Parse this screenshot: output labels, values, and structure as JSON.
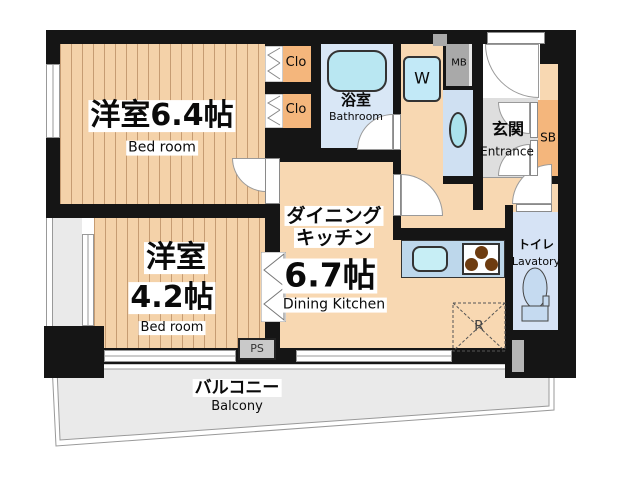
{
  "plan": {
    "title": "Japanese apartment floor plan (1DK with balcony)",
    "rooms": {
      "bedroom_64": {
        "name_jp": "洋室6.4帖",
        "name_en": "Bed room"
      },
      "bedroom_42": {
        "name_jp_line1": "洋室",
        "name_jp_line2": "4.2帖",
        "name_en": "Bed room"
      },
      "dining_kitchen": {
        "name_jp_line1": "ダイニング",
        "name_jp_line2": "キッチン",
        "size": "6.7帖",
        "name_en": "Dining Kitchen"
      },
      "bathroom": {
        "name_jp": "浴室",
        "name_en": "Bathroom"
      },
      "entrance": {
        "name_jp": "玄関",
        "name_en": "Entrance"
      },
      "toilet": {
        "name_jp": "トイレ",
        "name_en": "Lavatory"
      },
      "balcony": {
        "name_jp": "バルコニー",
        "name_en": "Balcony"
      }
    },
    "compartments": {
      "closet_top": "Clo",
      "closet_bottom": "Clo",
      "washer": "W",
      "meter_box": "MB",
      "shoe_box": "SB",
      "pipe_space": "PS",
      "refrigerator": "R"
    },
    "colors": {
      "wall": "#151515",
      "wood_floor": "#f4d2a9",
      "wood_stripe": "#c69c72",
      "dk_floor": "#f8d8b2",
      "closet": "#f4b67c",
      "bathroom_floor": "#d9e7f6",
      "tub": "#b9e7f2",
      "washer_pad": "#c2e9f7",
      "washbasin_floor": "#cfe0f2",
      "fixture": "#abe2ec",
      "counter": "#bdd7eb",
      "sink": "#c7eef5",
      "burner": "#6e3c10",
      "entrance_floor": "#dedede",
      "toilet_floor": "#d6e3f5",
      "balcony_floor": "#eaeaea",
      "box_gray": "#a9a9a9"
    }
  }
}
